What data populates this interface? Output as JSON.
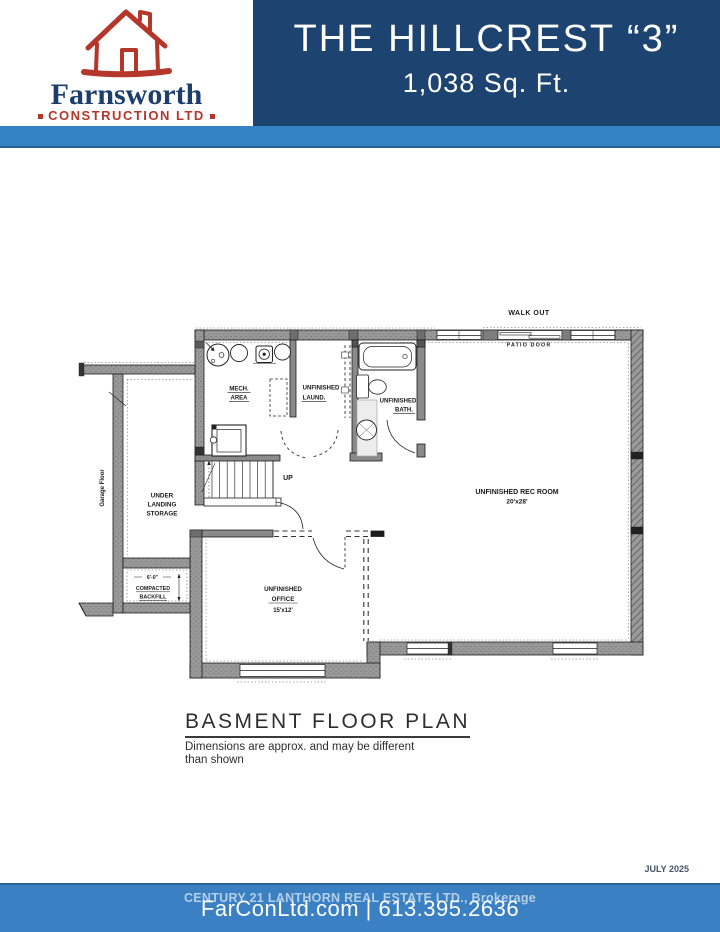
{
  "header": {
    "logo": {
      "company": "Farnsworth",
      "tagline": "CONSTRUCTION LTD"
    },
    "title": "THE HILLCREST “3”",
    "subtitle": "1,038 Sq. Ft."
  },
  "colors": {
    "header_navy": "#1d4470",
    "band_blue": "#3382c4",
    "footer_blue": "#3a80c2",
    "logo_red": "#b5362a",
    "logo_navy": "#1c3e6d",
    "wall_gray": "#989898"
  },
  "plan": {
    "labels": {
      "walk_out": "WALK OUT",
      "patio_door": "PATIO DOOR",
      "mech_line1": "MECH.",
      "mech_line2": "AREA",
      "laund_line1": "UNFINISHED",
      "laund_line2": "LAUND.",
      "bath_line1": "UNFINISHED",
      "bath_line2": "BATH.",
      "rec_line1": "UNFINISHED REC ROOM",
      "rec_line2": "20'x28'",
      "up": "UP",
      "storage_line1": "UNDER",
      "storage_line2": "LANDING",
      "storage_line3": "STORAGE",
      "garage_floor": "Garage Floor",
      "backfill_dim": "6'-0\"",
      "backfill_line1": "COMPACTED",
      "backfill_line2": "BACKFILL",
      "office_line1": "UNFINISHED",
      "office_line2": "OFFICE",
      "office_line3": "15'x12'"
    }
  },
  "caption": {
    "title": "BASMENT FLOOR PLAN",
    "note_line1": "Dimensions are approx. and may be different",
    "note_line2": "than shown"
  },
  "footer": {
    "date": "JULY 2025",
    "brokerage": "CENTURY 21 LANTHORN REAL ESTATE LTD., Brokerage",
    "contact": "FarConLtd.com | 613.395.2636"
  }
}
